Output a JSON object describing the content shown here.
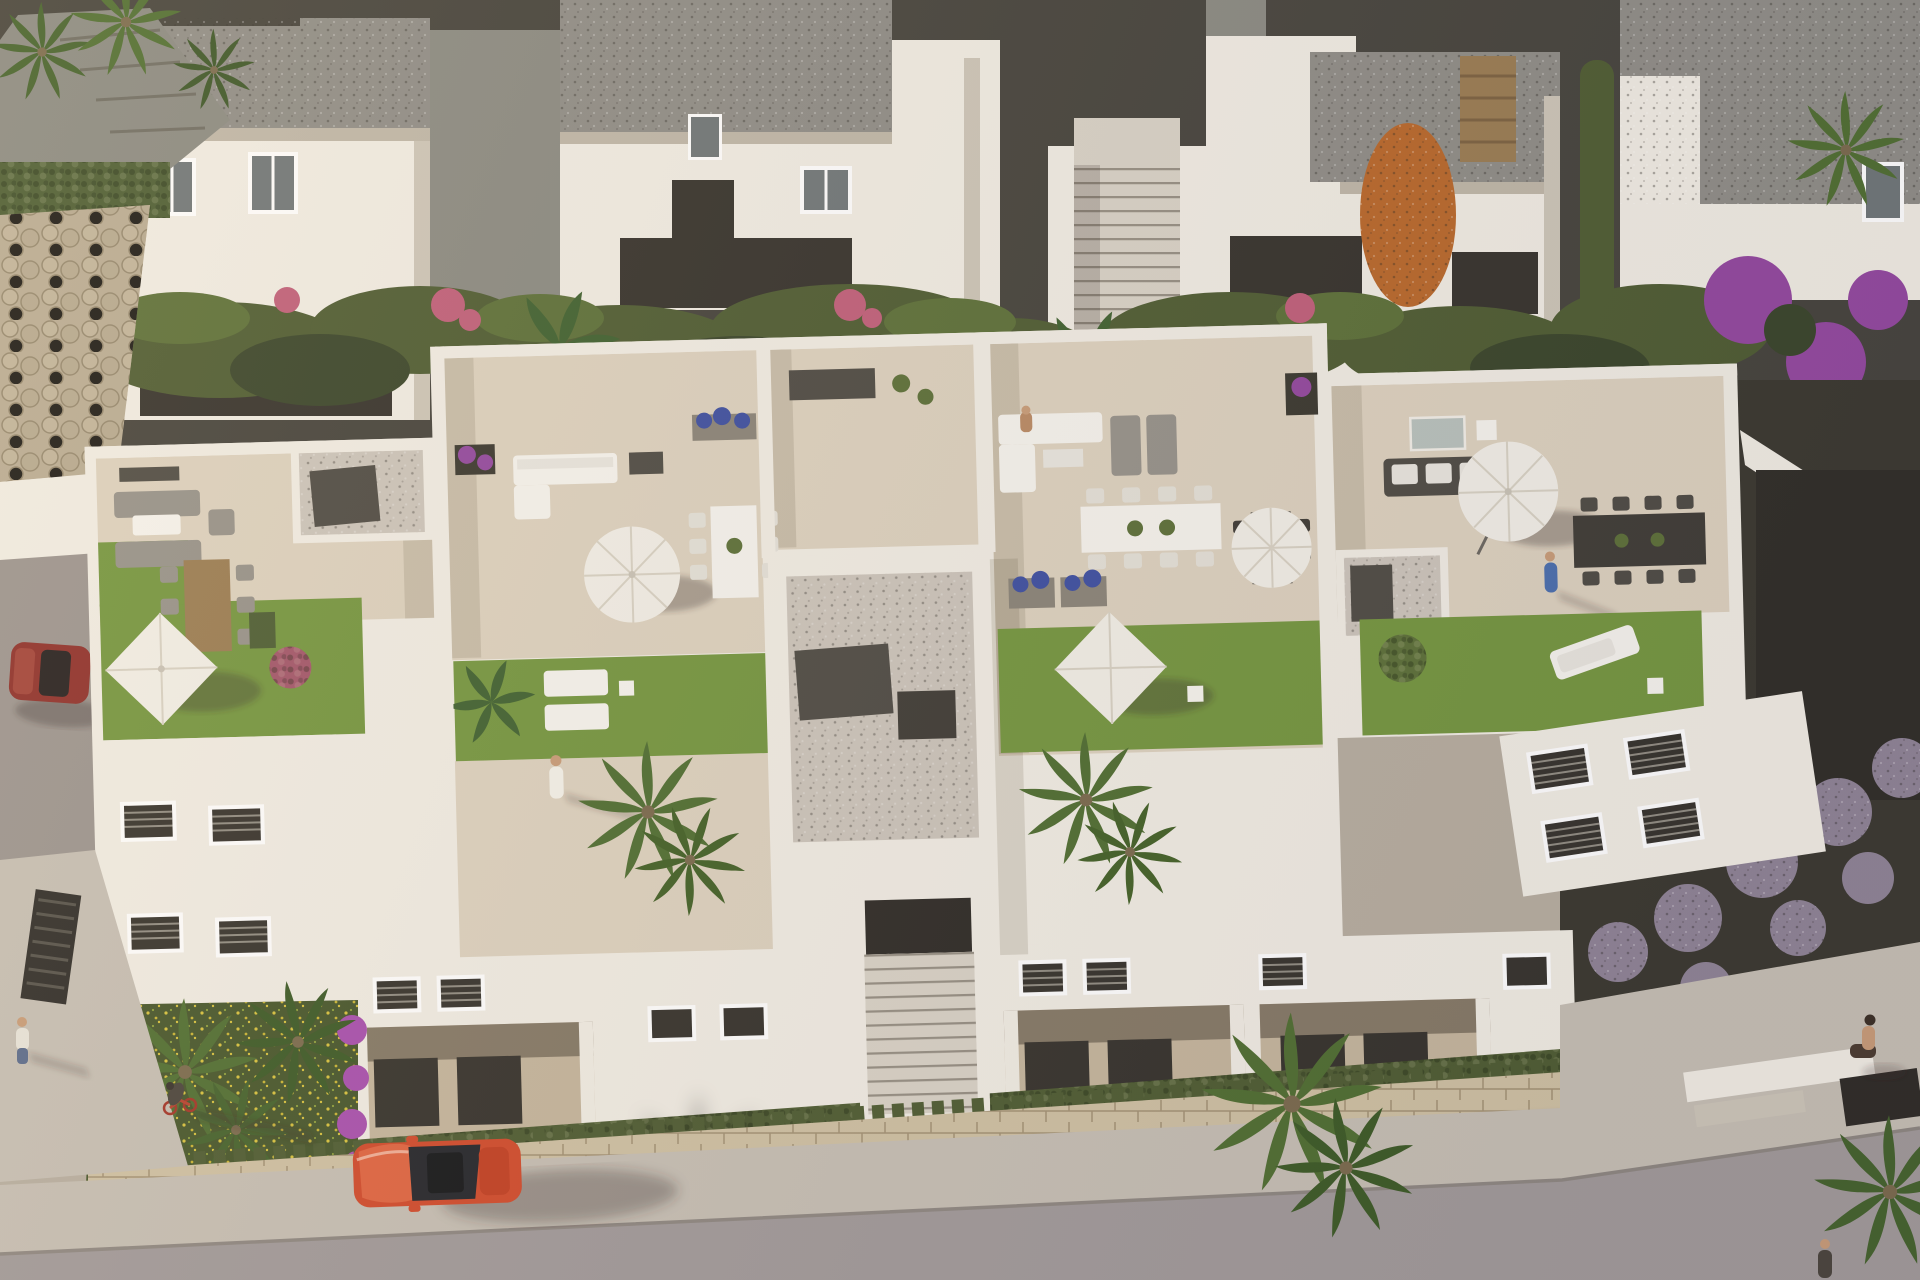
{
  "scene": {
    "type": "aerial-3d-architectural-render",
    "description": "Bird's-eye view of a modern white Mediterranean residential complex with rooftop terraces furnished with sofas, dining sets and white parasols, artificial lawns, gravel patios, dense hedges and palm trees, fronted by a stone boundary wall, a sidewalk and a street with a red car, a cyclist and pedestrians in warm low sunlight",
    "lighting": "low warm sun from the left casting long shadows to the right"
  },
  "palette": {
    "wall_white": "#f1ede4",
    "terrace_tile": "#ddd2bf",
    "roof_gravel": "#8f8d87",
    "path_dark": "#45433c",
    "hedge_green": "#4e5c32",
    "grass_green": "#74963f",
    "meadow_green": "#46562b",
    "orange_tree": "#b9682a",
    "bougainvillea": "#93489f",
    "blue_flower": "#3d4fa1",
    "stone_wall": "#cfc1a3",
    "boulder_wall": "#b9ac94",
    "gravel_light": "#ccc5bb",
    "sidewalk": "#c6bfb4",
    "road": "#a19a9a",
    "car_red": "#d14a2b",
    "car_maroon": "#8e2f2a",
    "parasol_white": "#f2efe7"
  },
  "inventory": {
    "rooftop_terraces": 5,
    "parasols": 6,
    "lawns": 6,
    "palm_trees": 9,
    "vehicles": [
      {
        "name": "red-car",
        "color": "#d14a2b",
        "location": "road, bottom center"
      },
      {
        "name": "parked-dark-red-car",
        "color": "#8e2f2a",
        "location": "left side driveway"
      }
    ],
    "people": [
      {
        "name": "cyclist",
        "location": "sidewalk bottom left"
      },
      {
        "name": "pedestrian-walking",
        "location": "left walkway"
      },
      {
        "name": "terrace-person-white",
        "location": "second rooftop terrace"
      },
      {
        "name": "terrace-person-seated",
        "location": "fourth terrace sofa"
      },
      {
        "name": "terrace-person-blue",
        "location": "right rooftop terrace"
      },
      {
        "name": "seated-person",
        "location": "bottom right plaza steps"
      }
    ]
  }
}
